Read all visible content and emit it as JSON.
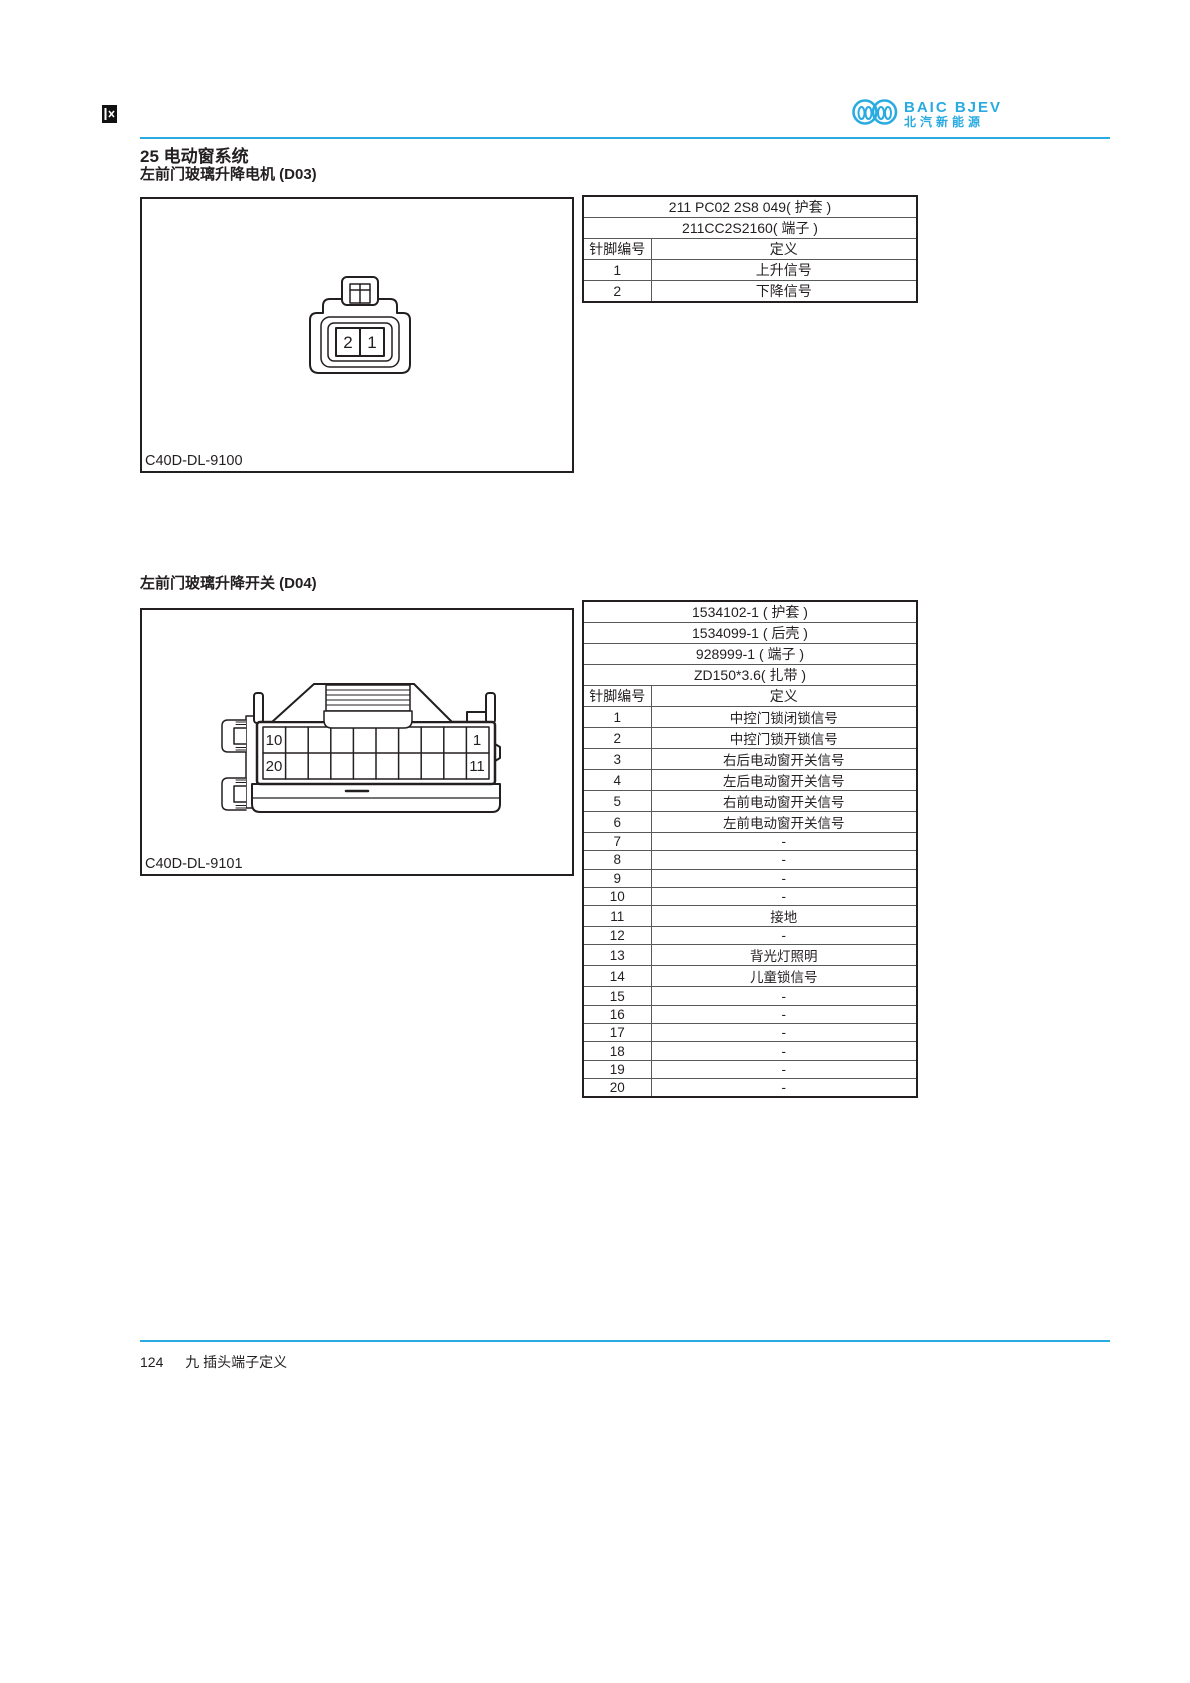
{
  "header": {
    "brand": "BAIC BJEV",
    "brand_cn": "北汽新能源",
    "brand_color": "#29abe2"
  },
  "page_title": "25 电动窗系统",
  "sections": [
    {
      "title": "左前门玻璃升降电机 (D03)",
      "figure_label": "C40D-DL-9100",
      "connector": {
        "type": "2-pin",
        "left_pin": "2",
        "right_pin": "1"
      },
      "table": {
        "part_rows": [
          "211 PC02 2S8 049( 护套 )",
          "211CC2S2160( 端子 )"
        ],
        "pin_header": "针脚编号",
        "def_header": "定义",
        "rows": [
          {
            "pin": "1",
            "def": "上升信号"
          },
          {
            "pin": "2",
            "def": "下降信号"
          }
        ]
      }
    },
    {
      "title": "左前门玻璃升降开关 (D04)",
      "figure_label": "C40D-DL-9101",
      "connector": {
        "type": "20-pin",
        "top_left": "10",
        "top_right": "1",
        "bottom_left": "20",
        "bottom_right": "11"
      },
      "table": {
        "part_rows": [
          "1534102-1 ( 护套 )",
          "1534099-1 ( 后壳 )",
          "928999-1 ( 端子 )",
          "ZD150*3.6( 扎带 )"
        ],
        "pin_header": "针脚编号",
        "def_header": "定义",
        "rows": [
          {
            "pin": "1",
            "def": "中控门锁闭锁信号"
          },
          {
            "pin": "2",
            "def": "中控门锁开锁信号"
          },
          {
            "pin": "3",
            "def": "右后电动窗开关信号"
          },
          {
            "pin": "4",
            "def": "左后电动窗开关信号"
          },
          {
            "pin": "5",
            "def": "右前电动窗开关信号"
          },
          {
            "pin": "6",
            "def": "左前电动窗开关信号"
          },
          {
            "pin": "7",
            "def": "-"
          },
          {
            "pin": "8",
            "def": "-"
          },
          {
            "pin": "9",
            "def": "-"
          },
          {
            "pin": "10",
            "def": "-"
          },
          {
            "pin": "11",
            "def": "接地"
          },
          {
            "pin": "12",
            "def": "-"
          },
          {
            "pin": "13",
            "def": "背光灯照明"
          },
          {
            "pin": "14",
            "def": "儿童锁信号"
          },
          {
            "pin": "15",
            "def": "-"
          },
          {
            "pin": "16",
            "def": "-"
          },
          {
            "pin": "17",
            "def": "-"
          },
          {
            "pin": "18",
            "def": "-"
          },
          {
            "pin": "19",
            "def": "-"
          },
          {
            "pin": "20",
            "def": "-"
          }
        ]
      }
    }
  ],
  "footer": {
    "page_number": "124",
    "chapter": "九 插头端子定义"
  }
}
